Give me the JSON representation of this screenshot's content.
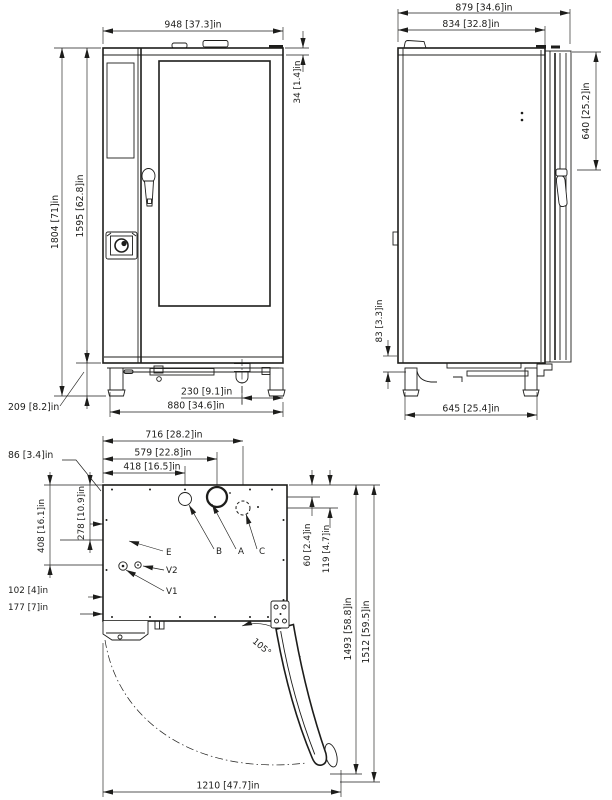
{
  "ink": "#1d1d1b",
  "views": {
    "front": {
      "dims": {
        "overall_width": "948 [37.3]in",
        "top_panel": "34 [1.4]in",
        "overall_height": "1804 [71]in",
        "body_height": "1595 [62.8]in",
        "leg_height": "209 [8.2]in",
        "drain_offset": "230 [9.1]in",
        "leg_span": "880 [34.6]in"
      }
    },
    "side": {
      "dims": {
        "overall_depth": "879 [34.6]in",
        "body_depth": "834 [32.8]in",
        "handle_top": "640 [25.2]in",
        "base_frame": "83 [3.3]in",
        "leg_span": "645 [25.4]in"
      }
    },
    "plan": {
      "dims": {
        "conn_c": "716 [28.2]in",
        "conn_a": "579 [22.8]in",
        "conn_b": "418 [16.5]in",
        "corner_offset": "86 [3.4]in",
        "row_e": "278 [10.9]in",
        "row_v": "408 [16.1]in",
        "e_offset": "102 [4]in",
        "v1_offset": "102 [4]in",
        "v2_offset": "177 [7]in",
        "row_ab_depth": "60 [2.4]in",
        "row_c_depth": "119 [4.7]in",
        "door_swing_depth": "1493 [58.8]in",
        "door_swing_total": "1512 [59.5]in",
        "door_open_width": "1210 [47.7]in",
        "door_angle": "105°"
      },
      "connections": {
        "e": "E",
        "b": "B",
        "a": "A",
        "c": "C",
        "v2": "V2",
        "v1": "V1"
      }
    }
  }
}
